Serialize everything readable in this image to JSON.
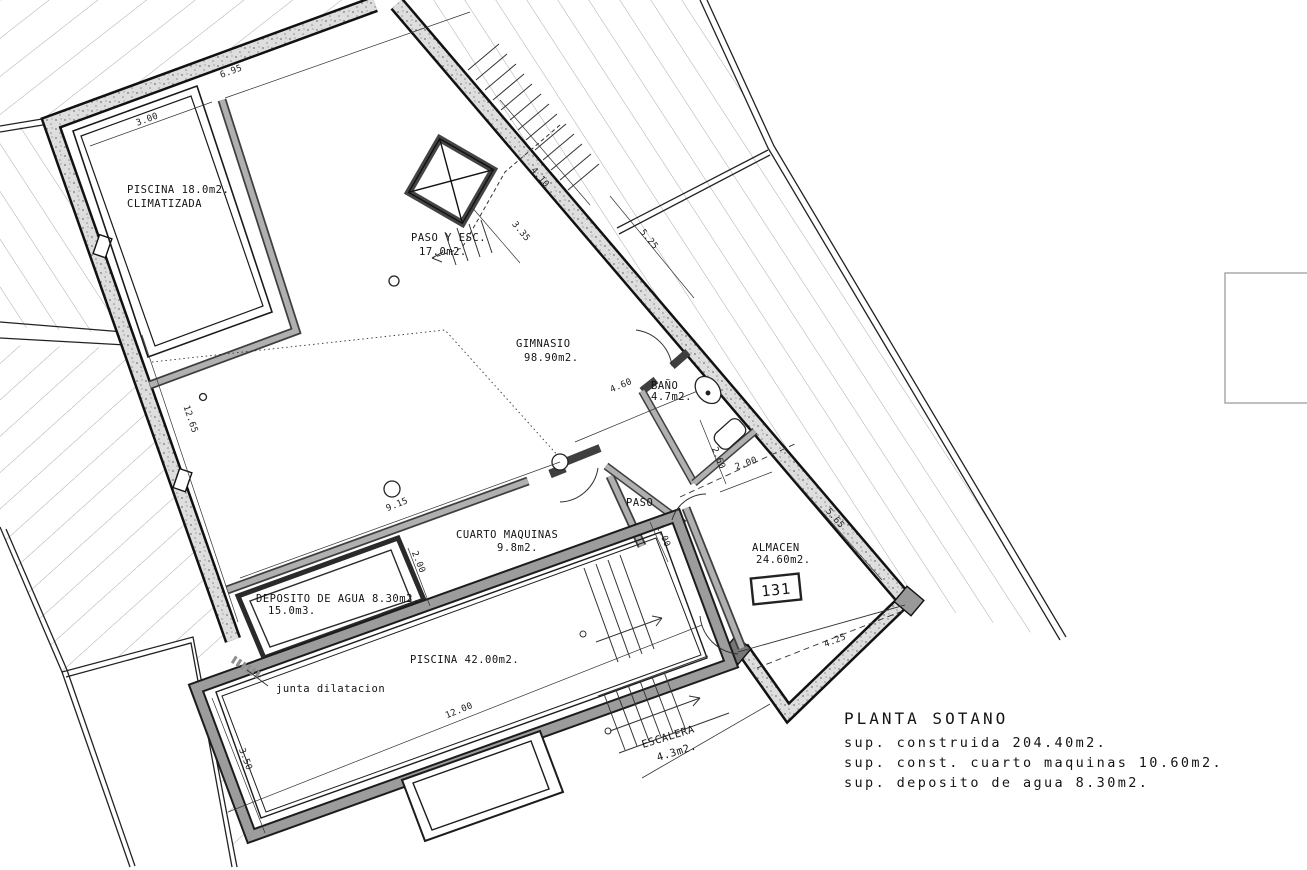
{
  "drawing": {
    "rooms": {
      "piscina_climatizada": {
        "line1": "PISCINA 18.0m2.",
        "line2": "CLIMATIZADA"
      },
      "paso_esc": {
        "line1": "PASO Y ESC.",
        "line2": "17.0m2."
      },
      "gimnasio": {
        "line1": "GIMNASIO",
        "line2": "98.90m2."
      },
      "bano": {
        "line1": "BAÑO",
        "line2": "4.7m2."
      },
      "paso": {
        "line1": "PASO"
      },
      "cuarto_maquinas": {
        "line1": "CUARTO MAQUINAS",
        "line2": "9.8m2."
      },
      "deposito": {
        "line1": "DEPOSITO DE AGUA 8.30m2.",
        "line2": "15.0m3."
      },
      "almacen": {
        "line1": "ALMACEN",
        "line2": "24.60m2.",
        "tag": "131"
      },
      "piscina_exterior": {
        "line1": "PISCINA 42.00m2."
      },
      "escalera": {
        "line1": "ESCALERA",
        "line2": "4.3m2."
      }
    },
    "annotations": {
      "junta": "junta dilatacion"
    },
    "dimensions": {
      "pool_width": "3.00",
      "top_wall": "6.95",
      "stair_side": "4.10",
      "stair_bottom": "3.35",
      "ne_upper": "5.25",
      "gym_left": "12.65",
      "gym_bottom": "9.15",
      "gym_se": "4.60",
      "bano_height": "2.60",
      "bano_width": "2.00",
      "cm_height": "2.00",
      "paso_width": "1.00",
      "ne_lower": "5.65",
      "almacen_bottom": "4.25",
      "pool_length": "12.00",
      "pool_width_ext": "3.50"
    },
    "title_block": {
      "title": "PLANTA SOTANO",
      "line1": "sup. construida 204.40m2.",
      "line2": "sup. const. cuarto maquinas 10.60m2.",
      "line3": "sup. deposito de agua 8.30m2."
    }
  }
}
